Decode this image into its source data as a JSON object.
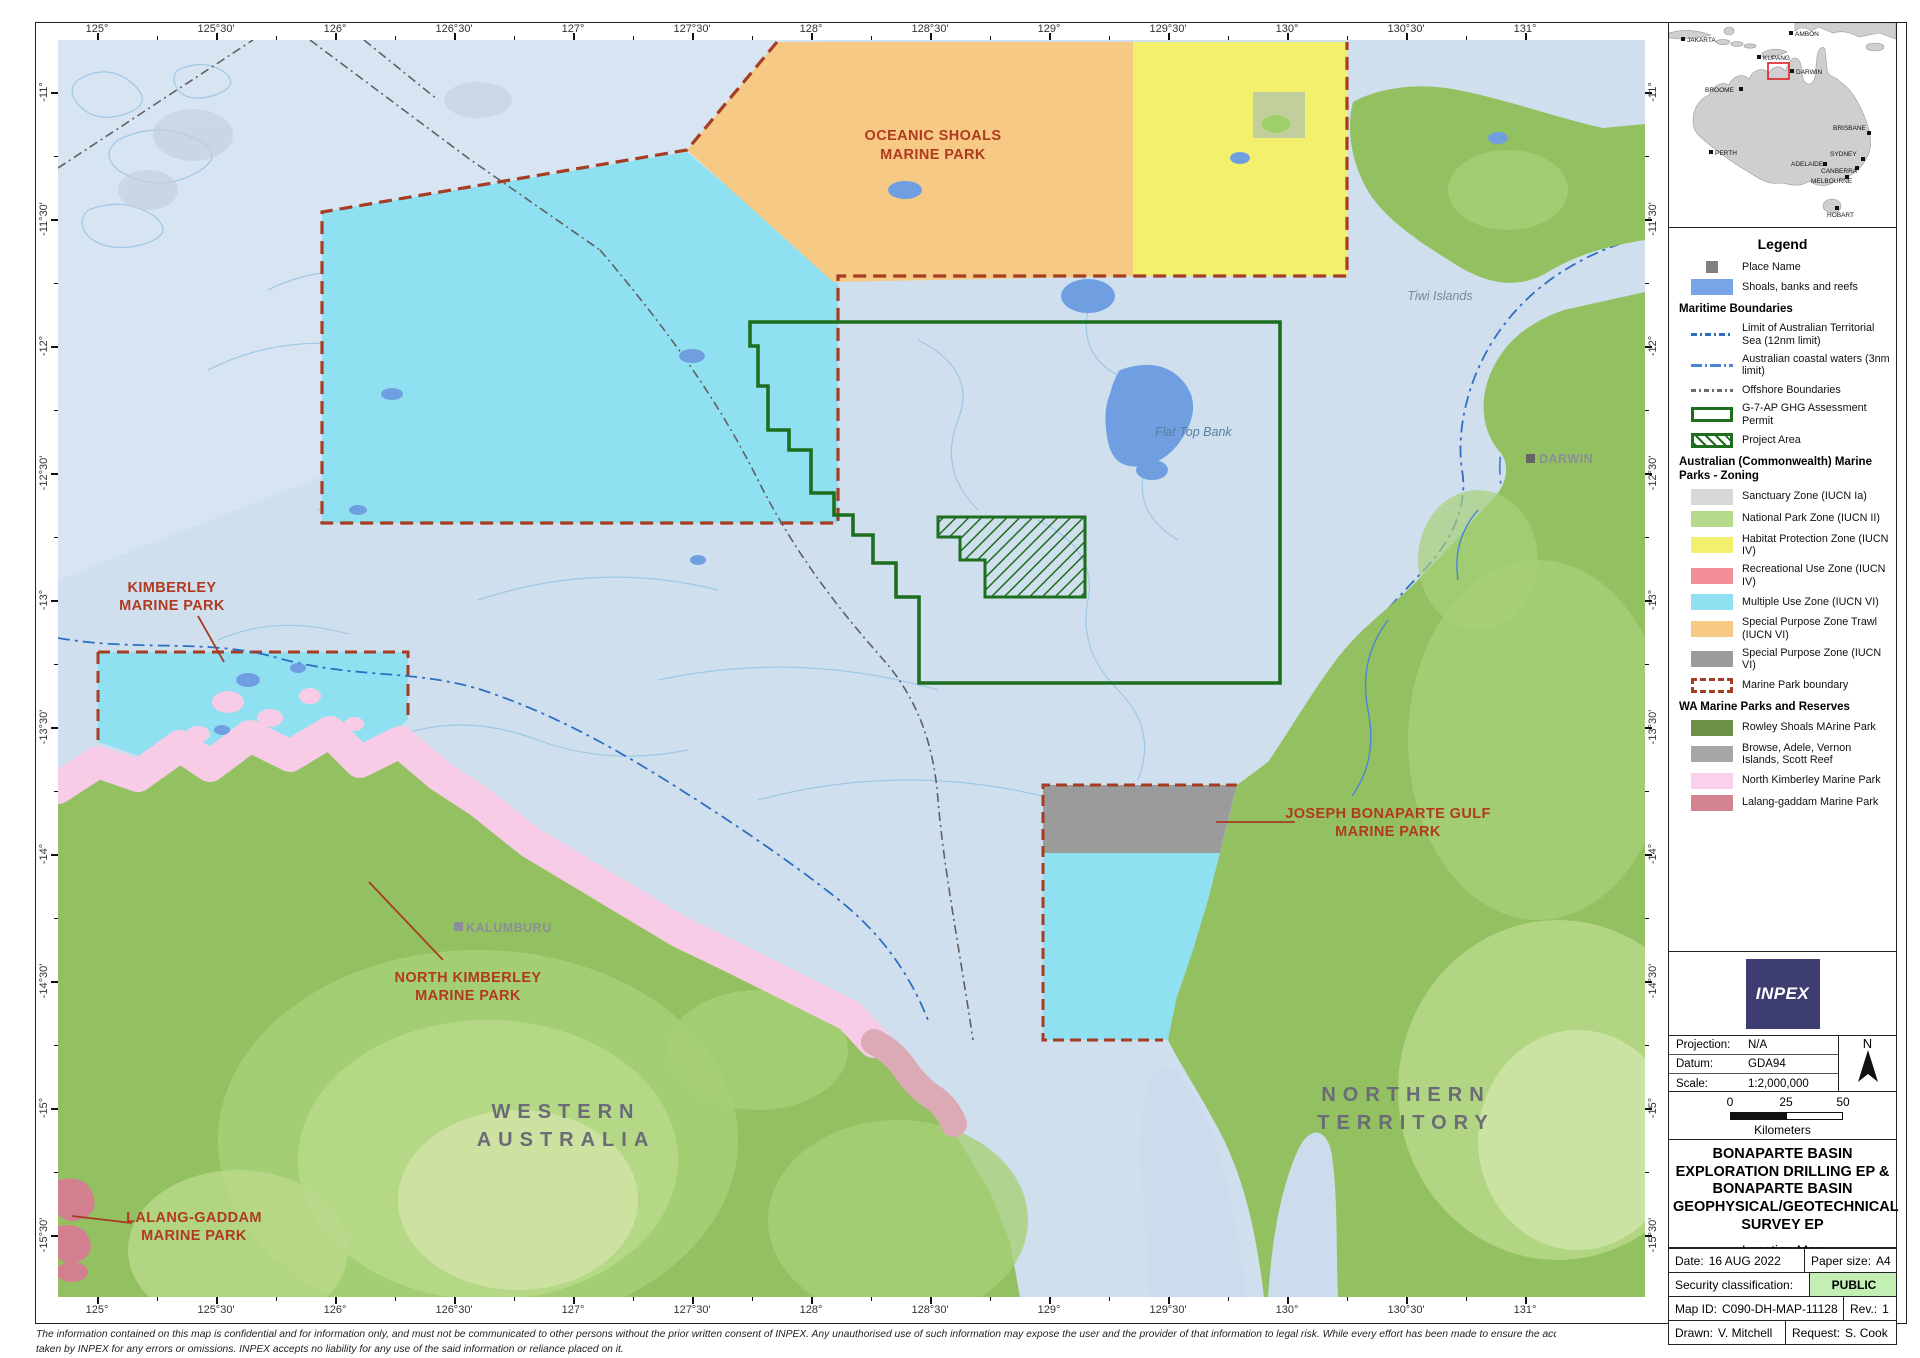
{
  "axes": {
    "lon": [
      "125°",
      "125°30'",
      "126°",
      "126°30'",
      "127°",
      "127°30'",
      "128°",
      "128°30'",
      "129°",
      "129°30'",
      "130°",
      "130°30'",
      "131°"
    ],
    "lat": [
      "-11°",
      "-11°30'",
      "-12°",
      "-12°30'",
      "-13°",
      "-13°30'",
      "-14°",
      "-14°30'",
      "-15°",
      "-15°30'"
    ]
  },
  "map_labels": {
    "oceanic1": "OCEANIC SHOALS",
    "oceanic2": "MARINE PARK",
    "kimberley1": "KIMBERLEY",
    "kimberley2": "MARINE PARK",
    "nk1": "NORTH KIMBERLEY",
    "nk2": "MARINE PARK",
    "lg1": "LALANG-GADDAM",
    "lg2": "MARINE PARK",
    "jbg1": "JOSEPH BONAPARTE GULF",
    "jbg2": "MARINE PARK",
    "wa1": "WESTERN",
    "wa2": "AUSTRALIA",
    "nt1": "NORTHERN",
    "nt2": "TERRITORY",
    "flat_top": "Flat Top Bank",
    "tiwi": "Tiwi Islands",
    "darwin": "DARWIN",
    "kalumburu": "KALUMBURU"
  },
  "inset": {
    "cities": [
      "JAKARTA",
      "AMBON",
      "KUPANG",
      "DARWIN",
      "BROOME",
      "PERTH",
      "BRISBANE",
      "SYDNEY",
      "ADELAIDE",
      "CANBERRA",
      "MELBOURNE",
      "HOBART"
    ]
  },
  "legend": {
    "title": "Legend",
    "sections": [
      {
        "header": "",
        "items": [
          {
            "sw": "place",
            "label": "Place Name"
          },
          {
            "sw": "shoals",
            "label": "Shoals, banks and reefs"
          }
        ]
      },
      {
        "header": "Maritime Boundaries",
        "items": [
          {
            "sw": "line sw-line-territorial",
            "label": "Limit of Australian Territorial Sea (12nm limit)"
          },
          {
            "sw": "line sw-line-coastal",
            "label": "Australian coastal waters (3nm limit)"
          },
          {
            "sw": "line sw-line-offshore",
            "label": "Offshore Boundaries"
          },
          {
            "sw": "permit",
            "label": "G-7-AP GHG Assessment Permit"
          },
          {
            "sw": "project",
            "label": "Project Area"
          }
        ]
      },
      {
        "header": "Australian (Commonwealth) Marine Parks - Zoning",
        "items": [
          {
            "sw": "sanctuary",
            "label": "Sanctuary Zone (IUCN Ia)"
          },
          {
            "sw": "national-park",
            "label": "National Park Zone (IUCN II)"
          },
          {
            "sw": "habitat",
            "label": "Habitat Protection Zone (IUCN IV)"
          },
          {
            "sw": "recreational",
            "label": "Recreational Use Zone (IUCN IV)"
          },
          {
            "sw": "multiple-use",
            "label": "Multiple Use Zone (IUCN VI)"
          },
          {
            "sw": "spz-trawl",
            "label": "Special Purpose Zone Trawl (IUCN VI)"
          },
          {
            "sw": "spz",
            "label": "Special Purpose Zone (IUCN VI)"
          },
          {
            "sw": "mp-boundary",
            "label": "Marine Park boundary"
          }
        ]
      },
      {
        "header": "WA Marine Parks and Reserves",
        "items": [
          {
            "sw": "rowley",
            "label": "Rowley Shoals MArine Park"
          },
          {
            "sw": "browse",
            "label": "Browse, Adele, Vernon Islands, Scott Reef"
          },
          {
            "sw": "nk",
            "label": "North Kimberley Marine Park"
          },
          {
            "sw": "lg",
            "label": "Lalang-gaddam Marine Park"
          }
        ]
      }
    ]
  },
  "title_block": {
    "logo": "INPEX",
    "projection_label": "Projection:",
    "projection": "N/A",
    "datum_label": "Datum:",
    "datum": "GDA94",
    "scale_label": "Scale:",
    "scale": "1:2,000,000",
    "north": "N",
    "scalebar": {
      "n0": "0",
      "n25": "25",
      "n50": "50",
      "unit": "Kilometers"
    },
    "title": "BONAPARTE BASIN EXPLORATION DRILLING EP & BONAPARTE BASIN GEOPHYSICAL/GEOTECHNICAL SURVEY EP",
    "subtitle": "Location Map",
    "date_label": "Date:",
    "date": "16 AUG 2022",
    "paper_label": "Paper size:",
    "paper": "A4",
    "security_label": "Security classification:",
    "security": "PUBLIC",
    "mapid_label": "Map ID:",
    "mapid": "C090-DH-MAP-11128",
    "rev_label": "Rev.:",
    "rev": "1",
    "drawn_label": "Drawn:",
    "drawn": "V. Mitchell",
    "request_label": "Request:",
    "request": "S. Cook"
  },
  "footer": {
    "line1": "The information contained on this map is confidential and for information only, and must not be communicated to other persons without the prior written consent of INPEX.  Any unauthorised use of such information may expose the user and the provider of that information to legal risk.  While every effort has been made to ensure the accuracy and completeness of the information presented, no guarantee is given nor responsibility",
    "line2": "taken by INPEX for any errors or omissions. INPEX accepts no liability for any use of the said information or reliance placed on it."
  },
  "colors": {
    "water": "#cfdfee",
    "multiple_use_cyan": "#8fe1f2",
    "spz_trawl_orange": "#f6ca84",
    "habitat_yellow": "#f3f06e",
    "spz_gray": "#9b9b9b",
    "land_green": "#93c161",
    "north_kimberley_pink": "#f8cbe6",
    "lalang_rose": "#d2808f",
    "shoal_blue": "#6f9fe0",
    "permit_green": "#1d6e1d",
    "boundary_red": "#a63c22",
    "label_red": "#b03a20",
    "inpex_navy": "#3d3d72",
    "public_green": "#c4efb4"
  }
}
